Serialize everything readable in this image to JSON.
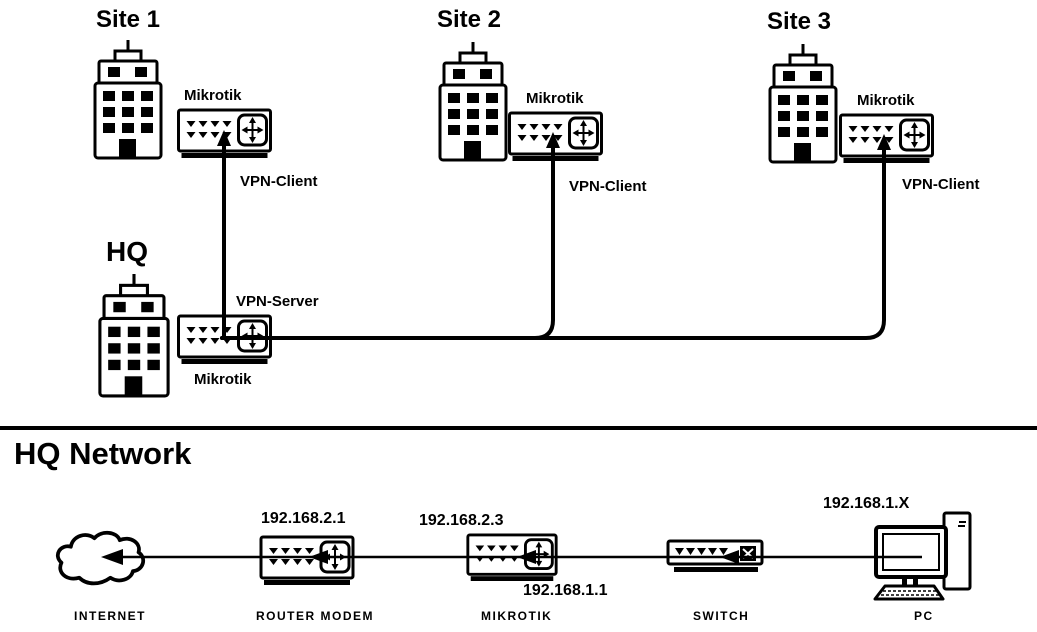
{
  "vpn": {
    "site1": {
      "name": "Site 1",
      "router": "Mikrotik",
      "role": "VPN-Client"
    },
    "site2": {
      "name": "Site 2",
      "router": "Mikrotik",
      "role": "VPN-Client"
    },
    "site3": {
      "name": "Site 3",
      "router": "Mikrotik",
      "role": "VPN-Client"
    },
    "hq": {
      "name": "HQ",
      "router": "Mikrotik",
      "role": "VPN-Server"
    }
  },
  "hq_network": {
    "title": "HQ Network",
    "internet": {
      "label": "INTERNET",
      "type": "cloud"
    },
    "router_modem": {
      "label": "ROUTER MODEM",
      "type": "router",
      "ip": "192.168.2.1"
    },
    "mikrotik": {
      "label": "MIKROTIK",
      "type": "router",
      "wan_ip": "192.168.2.3",
      "lan_ip": "192.168.1.1"
    },
    "switch": {
      "label": "SWITCH",
      "type": "switch"
    },
    "pc": {
      "label": "PC",
      "type": "computer",
      "ip": "192.168.1.X"
    }
  },
  "colors": {
    "ink": "#000000",
    "background": "#ffffff"
  }
}
